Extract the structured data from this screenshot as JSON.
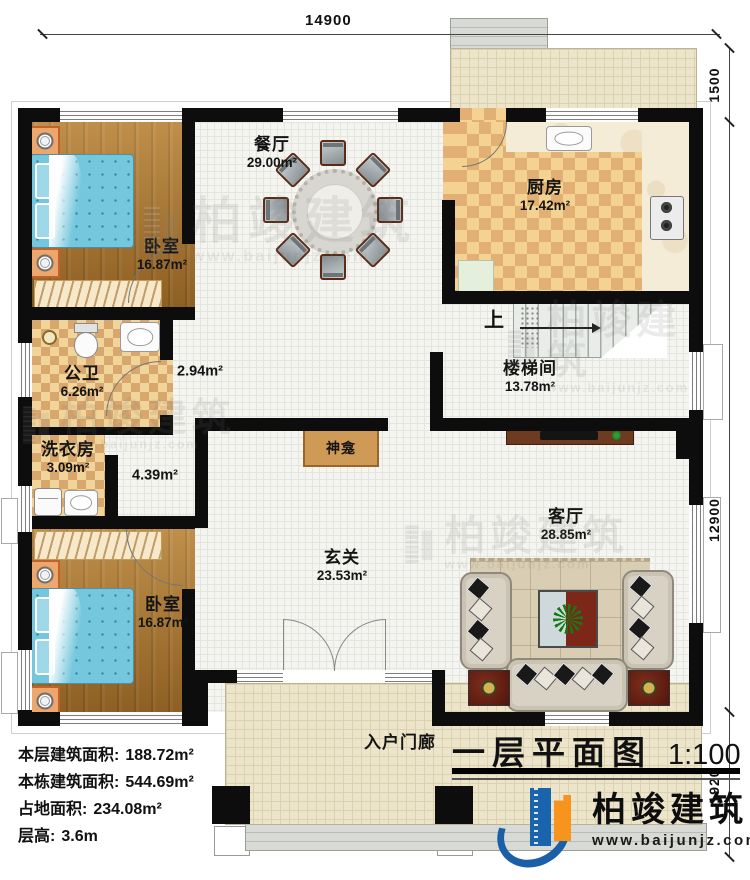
{
  "title_block": {
    "title": "一层平面图",
    "scale": "1:100"
  },
  "dimensions": {
    "top": "14900",
    "right_top": "1500",
    "right_middle": "12900",
    "right_bottom": "1920"
  },
  "rooms": {
    "bedroom1": {
      "name": "卧室",
      "area": "16.87m²"
    },
    "dining": {
      "name": "餐厅",
      "area": "29.00m²"
    },
    "kitchen": {
      "name": "厨房",
      "area": "17.42m²"
    },
    "bathroom": {
      "name": "公卫",
      "area": "6.26m²"
    },
    "hall_upper": {
      "area": "2.94m²"
    },
    "stairwell": {
      "name": "楼梯间",
      "area": "13.78m²",
      "up": "上"
    },
    "laundry": {
      "name": "洗衣房",
      "area": "3.09m²"
    },
    "hall_lower": {
      "area": "4.39m²"
    },
    "shrine": {
      "name": "神龛"
    },
    "foyer": {
      "name": "玄关",
      "area": "23.53m²"
    },
    "living": {
      "name": "客厅",
      "area": "28.85m²"
    },
    "bedroom2": {
      "name": "卧室",
      "area": "16.87m²"
    },
    "porch": {
      "name": "入户门廊"
    }
  },
  "stats": {
    "line1": {
      "label": "本层建筑面积:",
      "value": "188.72m²"
    },
    "line2": {
      "label": "本栋建筑面积:",
      "value": "544.69m²"
    },
    "line3": {
      "label": "占地面积:",
      "value": "234.08m²"
    },
    "line4": {
      "label": "层高:",
      "value": "3.6m"
    }
  },
  "branding": {
    "company": "柏竣建筑",
    "website": "www.baijunjz.com"
  },
  "watermark": {
    "company": "柏竣建筑",
    "website": "www.baijunjz.com"
  },
  "colors": {
    "wall": "#0d0d0d",
    "wood_floor": "#a9752e",
    "checker_light": "#f1d499",
    "checker_dark": "#d8a76e",
    "hall_tile": "#f4f4f1",
    "porch_tile": "#ece4cb",
    "bed": "#74c7dc",
    "shrine_wood": "#cf9a55",
    "logo_blue": "#1b5fa8",
    "logo_orange": "#f7941d"
  }
}
